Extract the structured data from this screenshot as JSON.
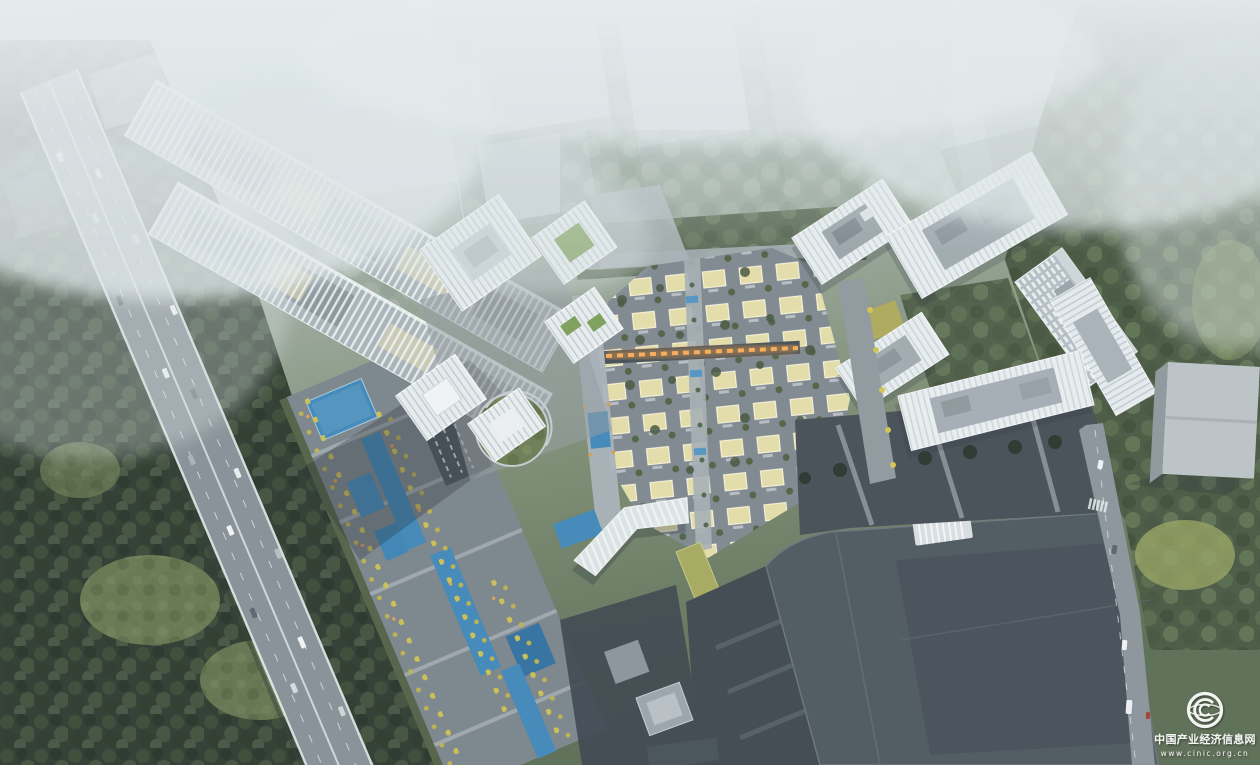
{
  "image": {
    "kind": "aerial-architectural-rendering",
    "description": "Bird's-eye master-plan rendering: a forested expressway on the left, long louvered linear slab buildings running diagonally, white striped office towers, a central low-rise yellow villa grid with an illuminated retail street, an eastern cluster of white high-rise slabs around a green courtyard, dark exhibition halls at the bottom and a landscaped pedestrian mall with blue pools and yellow trees. Misty haze covers the top of the scene."
  },
  "watermark": {
    "logo": "cinic-globe-icon",
    "name": "中国产业经济信息网",
    "url": "www.cinic.org.cn"
  },
  "palette": {
    "fog": "#e7edef",
    "forest_dark": "#2c392d",
    "forest_mid": "#47573f",
    "trees_hazy": "#93a397",
    "grass": "#6b7b51",
    "road": "#868f95",
    "street": "#7e868e",
    "lane_line": "#e8eef0",
    "building_white": "#e9edef",
    "building_stripe": "#b6c0c6",
    "roof_gray": "#9aa4aa",
    "factory_dark": "#4c555d",
    "factory_darker": "#3d454d",
    "villa_roof": "#e5dda9",
    "villa_edge": "#f7f3d8",
    "pool_blue": "#3e86b8",
    "tree_yellow": "#cdbf50",
    "green_roof": "#7d9e59",
    "glow_orange": "#e8973f",
    "shadow": "#20272e",
    "watermark_white": "#ffffff"
  }
}
